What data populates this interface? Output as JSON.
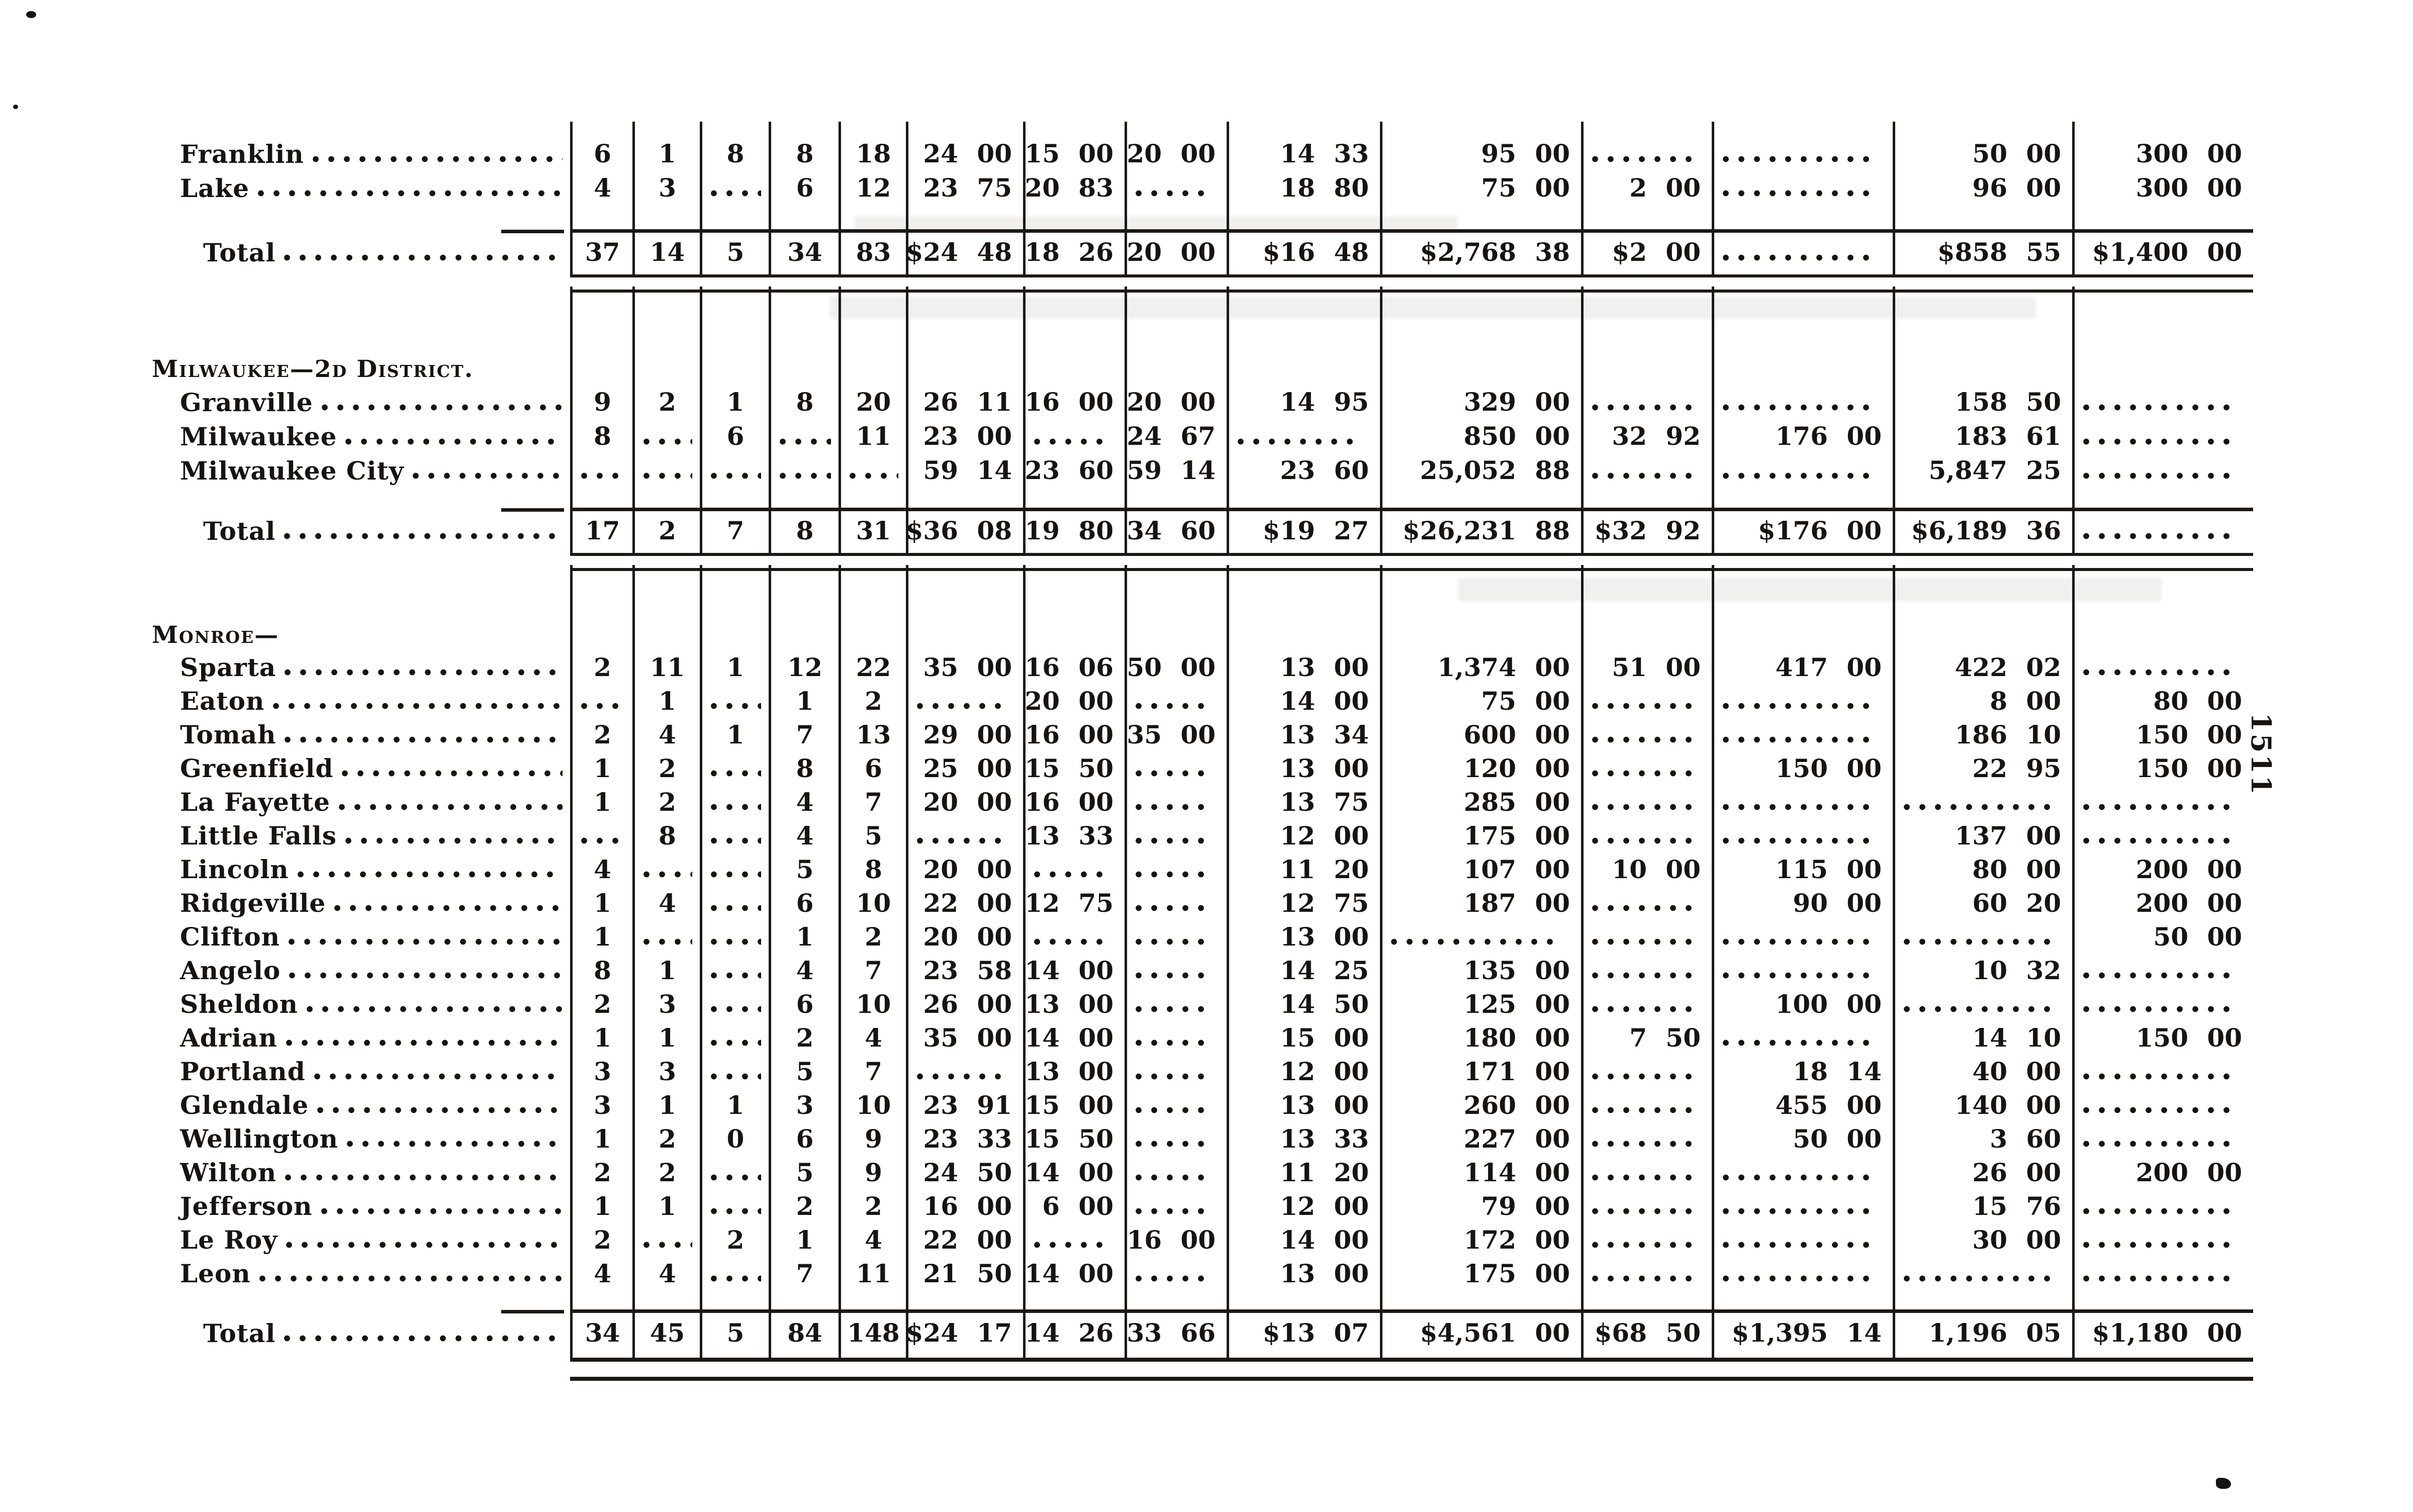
{
  "page": {
    "number_sideways": "1511",
    "ink_color": "#171310",
    "paper_color": "#ffffff"
  },
  "table": {
    "column_count": 14,
    "sections": [
      {
        "header": "",
        "rows": [
          {
            "name": "Franklin",
            "cells": [
              "6",
              "1",
              "8",
              "8",
              "18",
              "24 00",
              "15 00",
              "20 00",
              "14 33",
              "95 00",
              "…",
              "…",
              "50 00",
              "300 00"
            ]
          },
          {
            "name": "Lake",
            "cells": [
              "4",
              "3",
              "…",
              "6",
              "12",
              "23 75",
              "20 83",
              "…",
              "18 80",
              "75 00",
              "2 00",
              "…",
              "96 00",
              "300 00"
            ]
          }
        ],
        "total": {
          "label": "Total",
          "cells": [
            "37",
            "14",
            "5",
            "34",
            "83",
            "$24 48",
            "$18 26",
            "$20 00",
            "$16 48",
            "$2,768 38",
            "$2 00",
            "…",
            "$858 55",
            "$1,400 00"
          ]
        }
      },
      {
        "header": "Milwaukee—2d District.",
        "rows": [
          {
            "name": "Granville",
            "cells": [
              "9",
              "2",
              "1",
              "8",
              "20",
              "26 11",
              "16 00",
              "20 00",
              "14 95",
              "329 00",
              "…",
              "…",
              "158 50",
              "…"
            ]
          },
          {
            "name": "Milwaukee",
            "cells": [
              "8",
              "…",
              "6",
              "…",
              "11",
              "23 00",
              "…",
              "24 67",
              "…",
              "850 00",
              "32 92",
              "176 00",
              "183 61",
              "…"
            ]
          },
          {
            "name": "Milwaukee City",
            "cells": [
              "…",
              "…",
              "…",
              "…",
              "…",
              "59 14",
              "23 60",
              "59 14",
              "23 60",
              "25,052 88",
              "…",
              "…",
              "5,847 25",
              "…"
            ]
          }
        ],
        "total": {
          "label": "Total",
          "cells": [
            "17",
            "2",
            "7",
            "8",
            "31",
            "$36 08",
            "$19 80",
            "$34 60",
            "$19 27",
            "$26,231 88",
            "$32 92",
            "$176 00",
            "$6,189 36",
            "…"
          ]
        }
      },
      {
        "header": "Monroe—",
        "rows": [
          {
            "name": "Sparta",
            "cells": [
              "2",
              "11",
              "1",
              "12",
              "22",
              "35 00",
              "16 06",
              "50 00",
              "13 00",
              "1,374 00",
              "51 00",
              "417 00",
              "422 02",
              "…"
            ]
          },
          {
            "name": "Eaton",
            "cells": [
              "…",
              "1",
              "…",
              "1",
              "2",
              "…",
              "20 00",
              "…",
              "14 00",
              "75 00",
              "…",
              "…",
              "8 00",
              "80 00"
            ]
          },
          {
            "name": "Tomah",
            "cells": [
              "2",
              "4",
              "1",
              "7",
              "13",
              "29 00",
              "16 00",
              "35 00",
              "13 34",
              "600 00",
              "…",
              "…",
              "186 10",
              "150 00"
            ]
          },
          {
            "name": "Greenfield",
            "cells": [
              "1",
              "2",
              "…",
              "8",
              "6",
              "25 00",
              "15 50",
              "…",
              "13 00",
              "120 00",
              "…",
              "150 00",
              "22 95",
              "150 00"
            ]
          },
          {
            "name": "La Fayette",
            "cells": [
              "1",
              "2",
              "…",
              "4",
              "7",
              "20 00",
              "16 00",
              "…",
              "13 75",
              "285 00",
              "…",
              "…",
              "…",
              "…"
            ]
          },
          {
            "name": "Little Falls",
            "cells": [
              "…",
              "8",
              "…",
              "4",
              "5",
              "…",
              "13 33",
              "…",
              "12 00",
              "175 00",
              "…",
              "…",
              "137 00",
              "…"
            ]
          },
          {
            "name": "Lincoln",
            "cells": [
              "4",
              "…",
              "…",
              "5",
              "8",
              "20 00",
              "…",
              "…",
              "11 20",
              "107 00",
              "10 00",
              "115 00",
              "80 00",
              "200 00"
            ]
          },
          {
            "name": "Ridgeville",
            "cells": [
              "1",
              "4",
              "…",
              "6",
              "10",
              "22 00",
              "12 75",
              "…",
              "12 75",
              "187 00",
              "…",
              "90 00",
              "60 20",
              "200 00"
            ]
          },
          {
            "name": "Clifton",
            "cells": [
              "1",
              "…",
              "…",
              "1",
              "2",
              "20 00",
              "…",
              "…",
              "13 00",
              "…",
              "…",
              "…",
              "…",
              "50 00"
            ]
          },
          {
            "name": "Angelo",
            "cells": [
              "8",
              "1",
              "…",
              "4",
              "7",
              "23 58",
              "14 00",
              "…",
              "14 25",
              "135 00",
              "…",
              "…",
              "10 32",
              "…"
            ]
          },
          {
            "name": "Sheldon",
            "cells": [
              "2",
              "3",
              "…",
              "6",
              "10",
              "26 00",
              "13 00",
              "…",
              "14 50",
              "125 00",
              "…",
              "100 00",
              "…",
              "…"
            ]
          },
          {
            "name": "Adrian",
            "cells": [
              "1",
              "1",
              "…",
              "2",
              "4",
              "35 00",
              "14 00",
              "…",
              "15 00",
              "180 00",
              "7 50",
              "…",
              "14 10",
              "150 00"
            ]
          },
          {
            "name": "Portland",
            "cells": [
              "3",
              "3",
              "…",
              "5",
              "7",
              "…",
              "13 00",
              "…",
              "12 00",
              "171 00",
              "…",
              "18 14",
              "40 00",
              "…"
            ]
          },
          {
            "name": "Glendale",
            "cells": [
              "3",
              "1",
              "1",
              "3",
              "10",
              "23 91",
              "15 00",
              "…",
              "13 00",
              "260 00",
              "…",
              "455 00",
              "140 00",
              "…"
            ]
          },
          {
            "name": "Wellington",
            "cells": [
              "1",
              "2",
              "0",
              "6",
              "9",
              "23 33",
              "15 50",
              "…",
              "13 33",
              "227 00",
              "…",
              "50 00",
              "3 60",
              "…"
            ]
          },
          {
            "name": "Wilton",
            "cells": [
              "2",
              "2",
              "…",
              "5",
              "9",
              "24 50",
              "14 00",
              "…",
              "11 20",
              "114 00",
              "…",
              "…",
              "26 00",
              "200 00"
            ]
          },
          {
            "name": "Jefferson",
            "cells": [
              "1",
              "1",
              "…",
              "2",
              "2",
              "16 00",
              "6 00",
              "…",
              "12 00",
              "79 00",
              "…",
              "…",
              "15 76",
              "…"
            ]
          },
          {
            "name": "Le Roy",
            "cells": [
              "2",
              "…",
              "2",
              "1",
              "4",
              "22 00",
              "…",
              "16 00",
              "14 00",
              "172 00",
              "…",
              "…",
              "30 00",
              "…"
            ]
          },
          {
            "name": "Leon",
            "cells": [
              "4",
              "4",
              "…",
              "7",
              "11",
              "21 50",
              "14 00",
              "…",
              "13 00",
              "175 00",
              "…",
              "…",
              "…",
              "…"
            ]
          }
        ],
        "total": {
          "label": "Total",
          "cells": [
            "34",
            "45",
            "5",
            "84",
            "148",
            "$24 17",
            "$14 26",
            "$33 66",
            "$13 07",
            "$4,561 00",
            "$68 50",
            "$1,395 14",
            "1,196 05",
            "$1,180 00"
          ]
        }
      }
    ]
  }
}
